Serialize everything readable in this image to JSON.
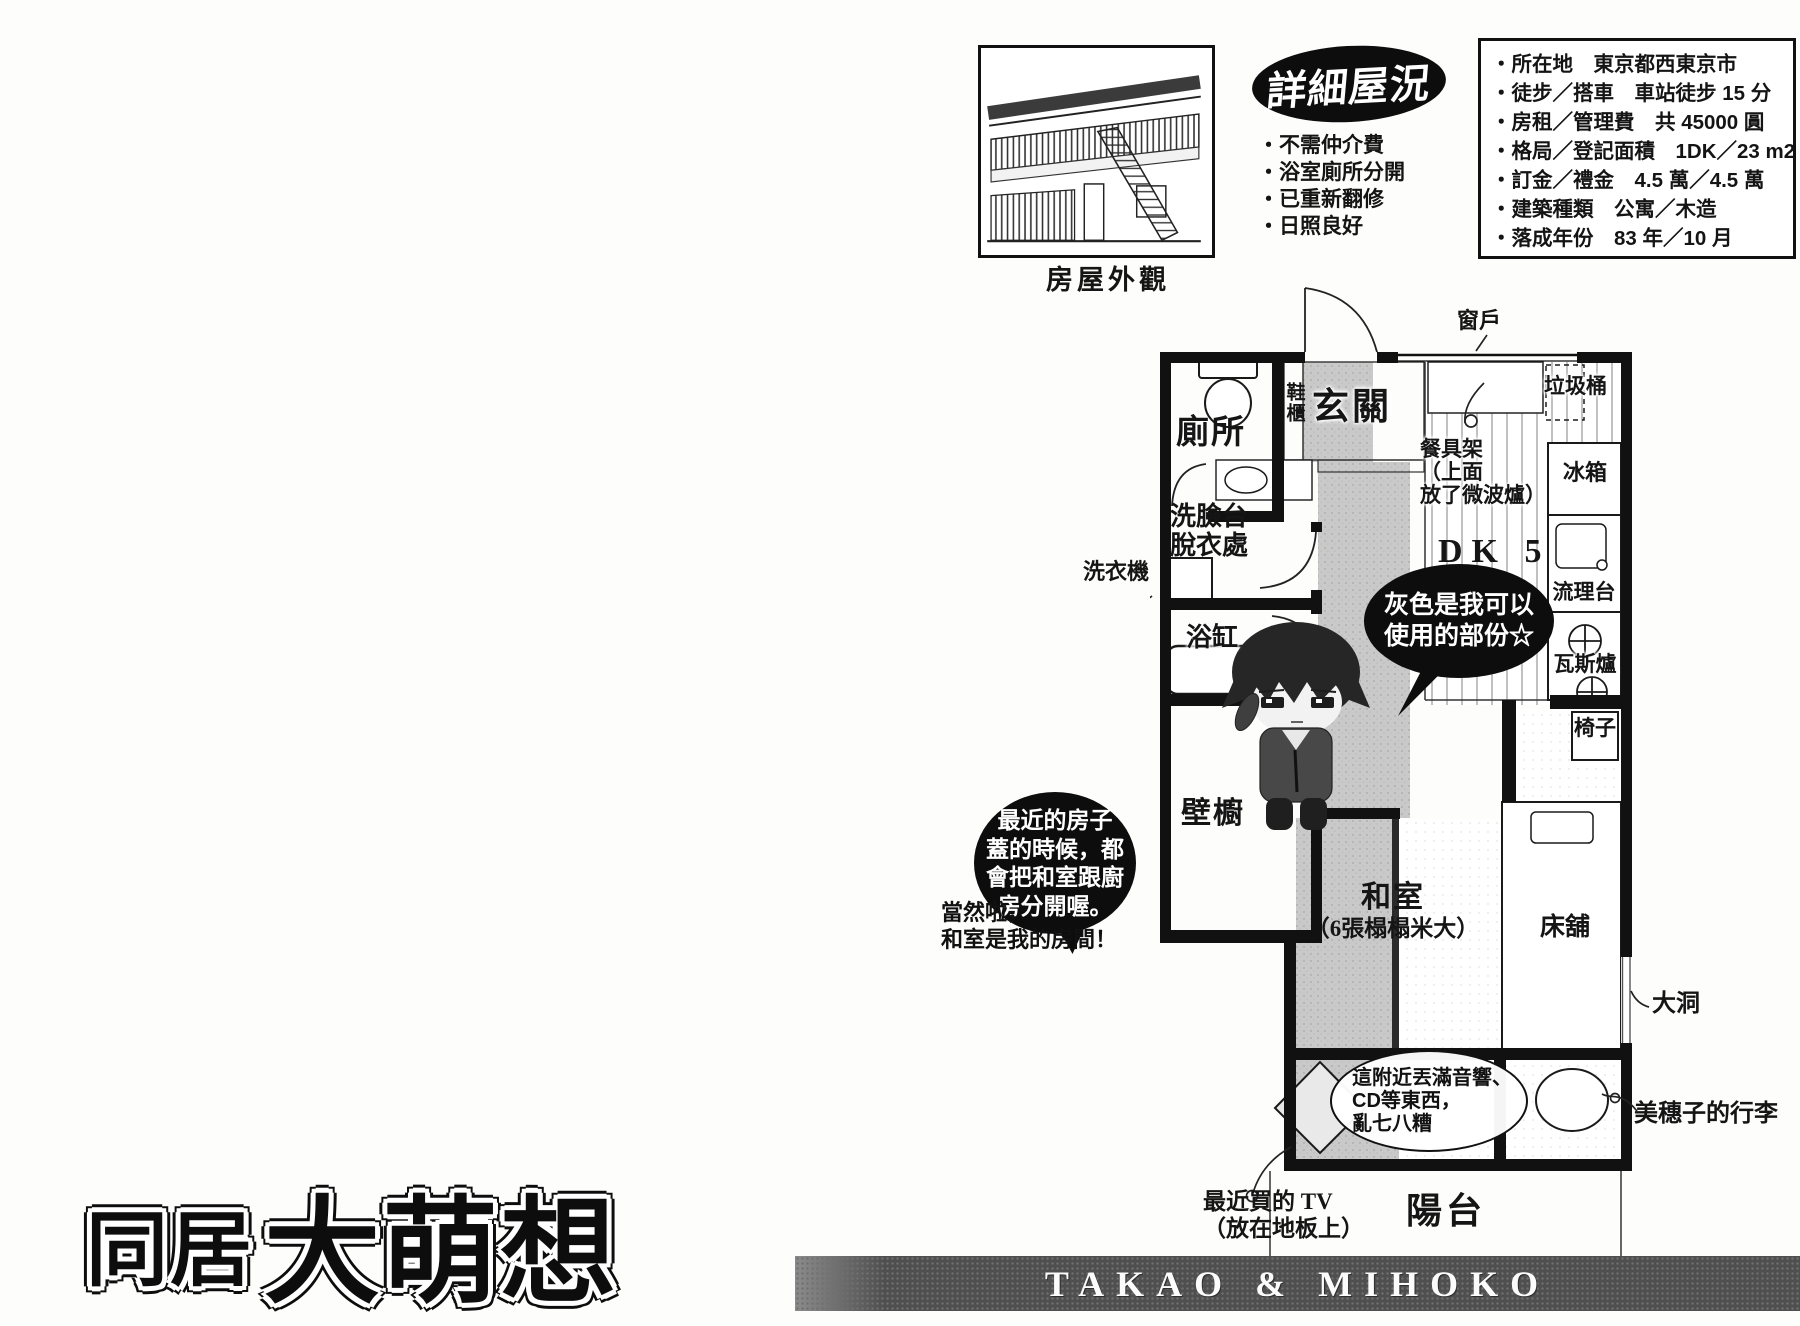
{
  "info": {
    "badge": "詳細屋況",
    "photo_caption": "房屋外觀",
    "highlights": [
      "・不需仲介費",
      "・浴室廁所分開",
      "・已重新翻修",
      "・日照良好"
    ],
    "details": [
      "・所在地　東京都西東京市",
      "・徒步／搭車　車站徒步 15 分",
      "・房租／管理費　共 45000 圓",
      "・格局／登記面積　1DK／23 m2",
      "・訂金／禮金　4.5 萬／4.5 萬",
      "・建築種類　公寓／木造",
      "・落成年份　83 年／10 月"
    ]
  },
  "plan": {
    "rooms": {
      "genkan": "玄關",
      "shoe_cabinet": "鞋櫃",
      "toilet": "廁所",
      "washbasin_1": "洗臉台",
      "washbasin_2": "脫衣處",
      "bath": "浴缸",
      "closet": "壁櫥",
      "dk": "DK 5",
      "washitsu": "和室",
      "washitsu_size": "（6張榻榻米大）",
      "balcony": "陽台"
    },
    "items": {
      "window": "窗戶",
      "trash": "垃圾桶",
      "fridge": "冰箱",
      "sink": "流理台",
      "stove": "瓦斯爐",
      "chair": "椅子",
      "washer": "洗衣機",
      "bed": "床舖",
      "hole": "大洞",
      "luggage": "美穗子的行李",
      "dish_rack_1": "餐具架",
      "dish_rack_2": "（上面",
      "dish_rack_3": "放了微波爐）",
      "tv_1": "最近買的 TV",
      "tv_2": "（放在地板上）"
    }
  },
  "speech": {
    "gray_1": "灰色是我可以",
    "gray_2": "使用的部份☆",
    "recent_1": "最近的房子",
    "recent_2": "蓋的時候，都",
    "recent_3": "會把和室跟廚",
    "recent_4": "房分開喔。",
    "ofcourse_1": "當然啦，",
    "ofcourse_2": "和室是我的房間！",
    "mess_1": "這附近丟滿音響、",
    "mess_2": "CD等東西，",
    "mess_3": "亂七八糟"
  },
  "title": {
    "part1": "同居",
    "part2": "大萌想"
  },
  "footer": {
    "credit": "TAKAO & MIHOKO"
  },
  "colors": {
    "ink": "#111111",
    "floor_gray": "#c9c9c9",
    "bar_gray": "#4f4f4f"
  }
}
